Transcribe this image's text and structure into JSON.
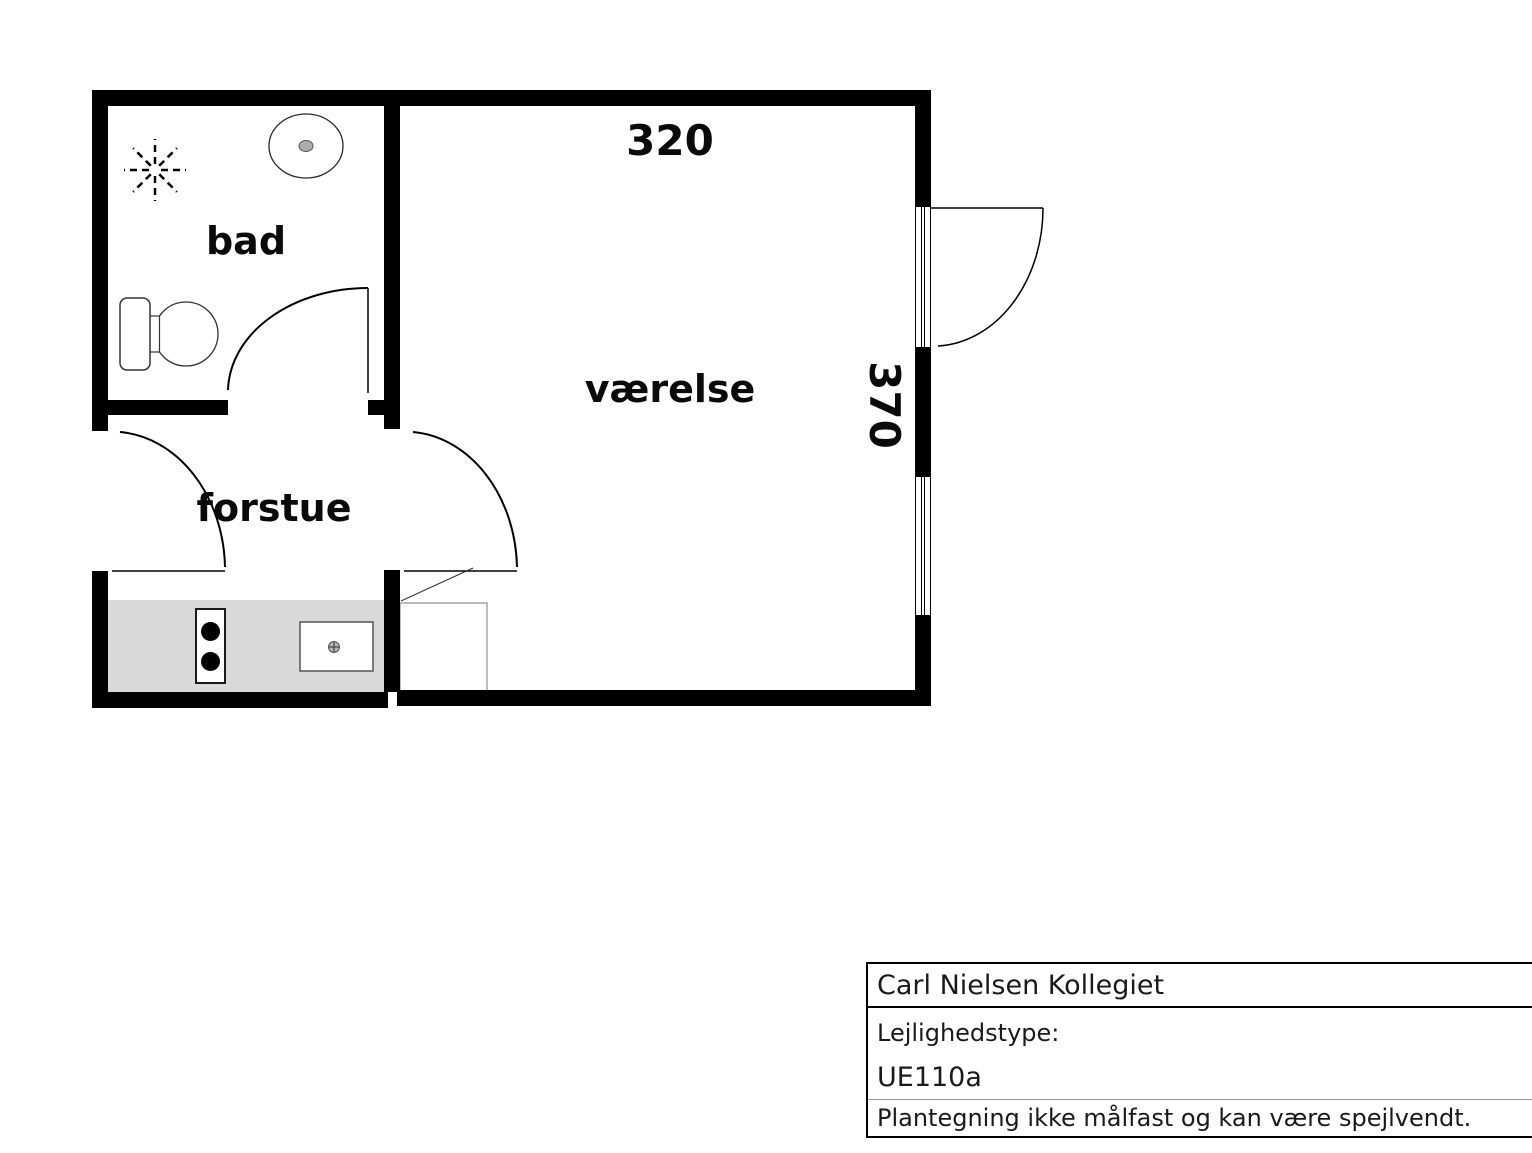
{
  "floorplan": {
    "rooms": [
      {
        "id": "bad",
        "label": "bad"
      },
      {
        "id": "forstue",
        "label": "forstue"
      },
      {
        "id": "vaerelse",
        "label": "værelse"
      }
    ],
    "dimensions": {
      "top": "320",
      "right": "370"
    },
    "fixtures": [
      "shower",
      "washbasin",
      "toilet",
      "stove",
      "kitchen-sink",
      "cabinet",
      "balcony-door",
      "window",
      "entry-door"
    ],
    "colors": {
      "wall": "#000000",
      "kitchen_counter": "#d9d9d9",
      "fixture_outline": "#333333"
    }
  },
  "title_block": {
    "building": "Carl Nielsen Kollegiet",
    "type_label": "Lejlighedstype:",
    "type_value": "UE110a",
    "disclaimer": "Plantegning ikke målfast og kan være spejlvendt."
  }
}
